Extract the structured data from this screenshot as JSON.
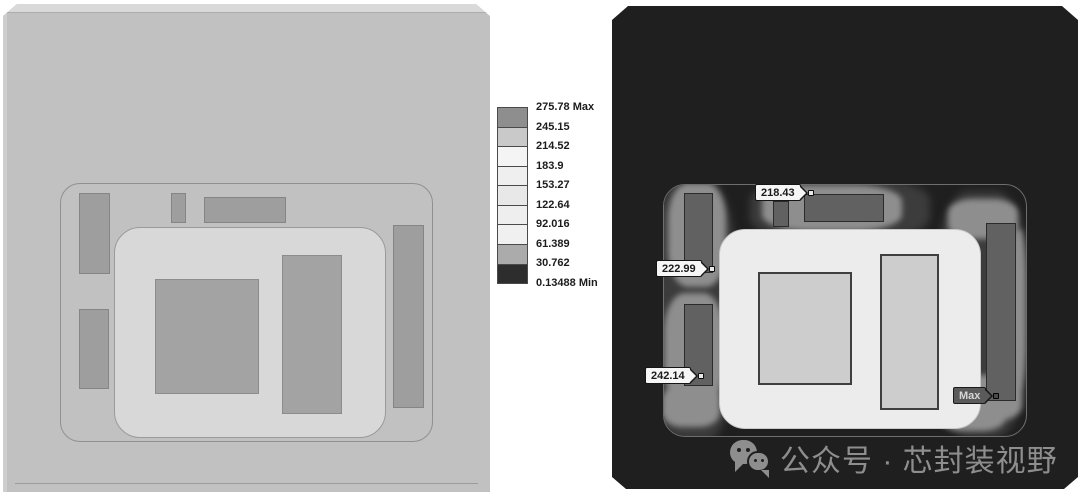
{
  "legend": {
    "ticks": [
      "275.78 Max",
      "245.15",
      "214.52",
      "183.9",
      "153.27",
      "122.64",
      "92.016",
      "61.389",
      "30.762",
      "0.13488 Min"
    ],
    "band_colors": [
      "#8e8e8e",
      "#c9c9c9",
      "#f4f4f4",
      "#efefef",
      "#e8e8e8",
      "#eeeeee",
      "#f0f0f0",
      "#ababab",
      "#2d2d2d"
    ]
  },
  "thermal_view": {
    "background": "#1f1f1f",
    "probes": [
      {
        "value": "218.43"
      },
      {
        "value": "222.99"
      },
      {
        "value": "242.14"
      },
      {
        "value": "Max"
      }
    ]
  },
  "geometry_view": {
    "background": "#c1c1c1"
  },
  "watermark": {
    "text": "公众号 · 芯封装视野",
    "color": "#8e8e8e"
  }
}
